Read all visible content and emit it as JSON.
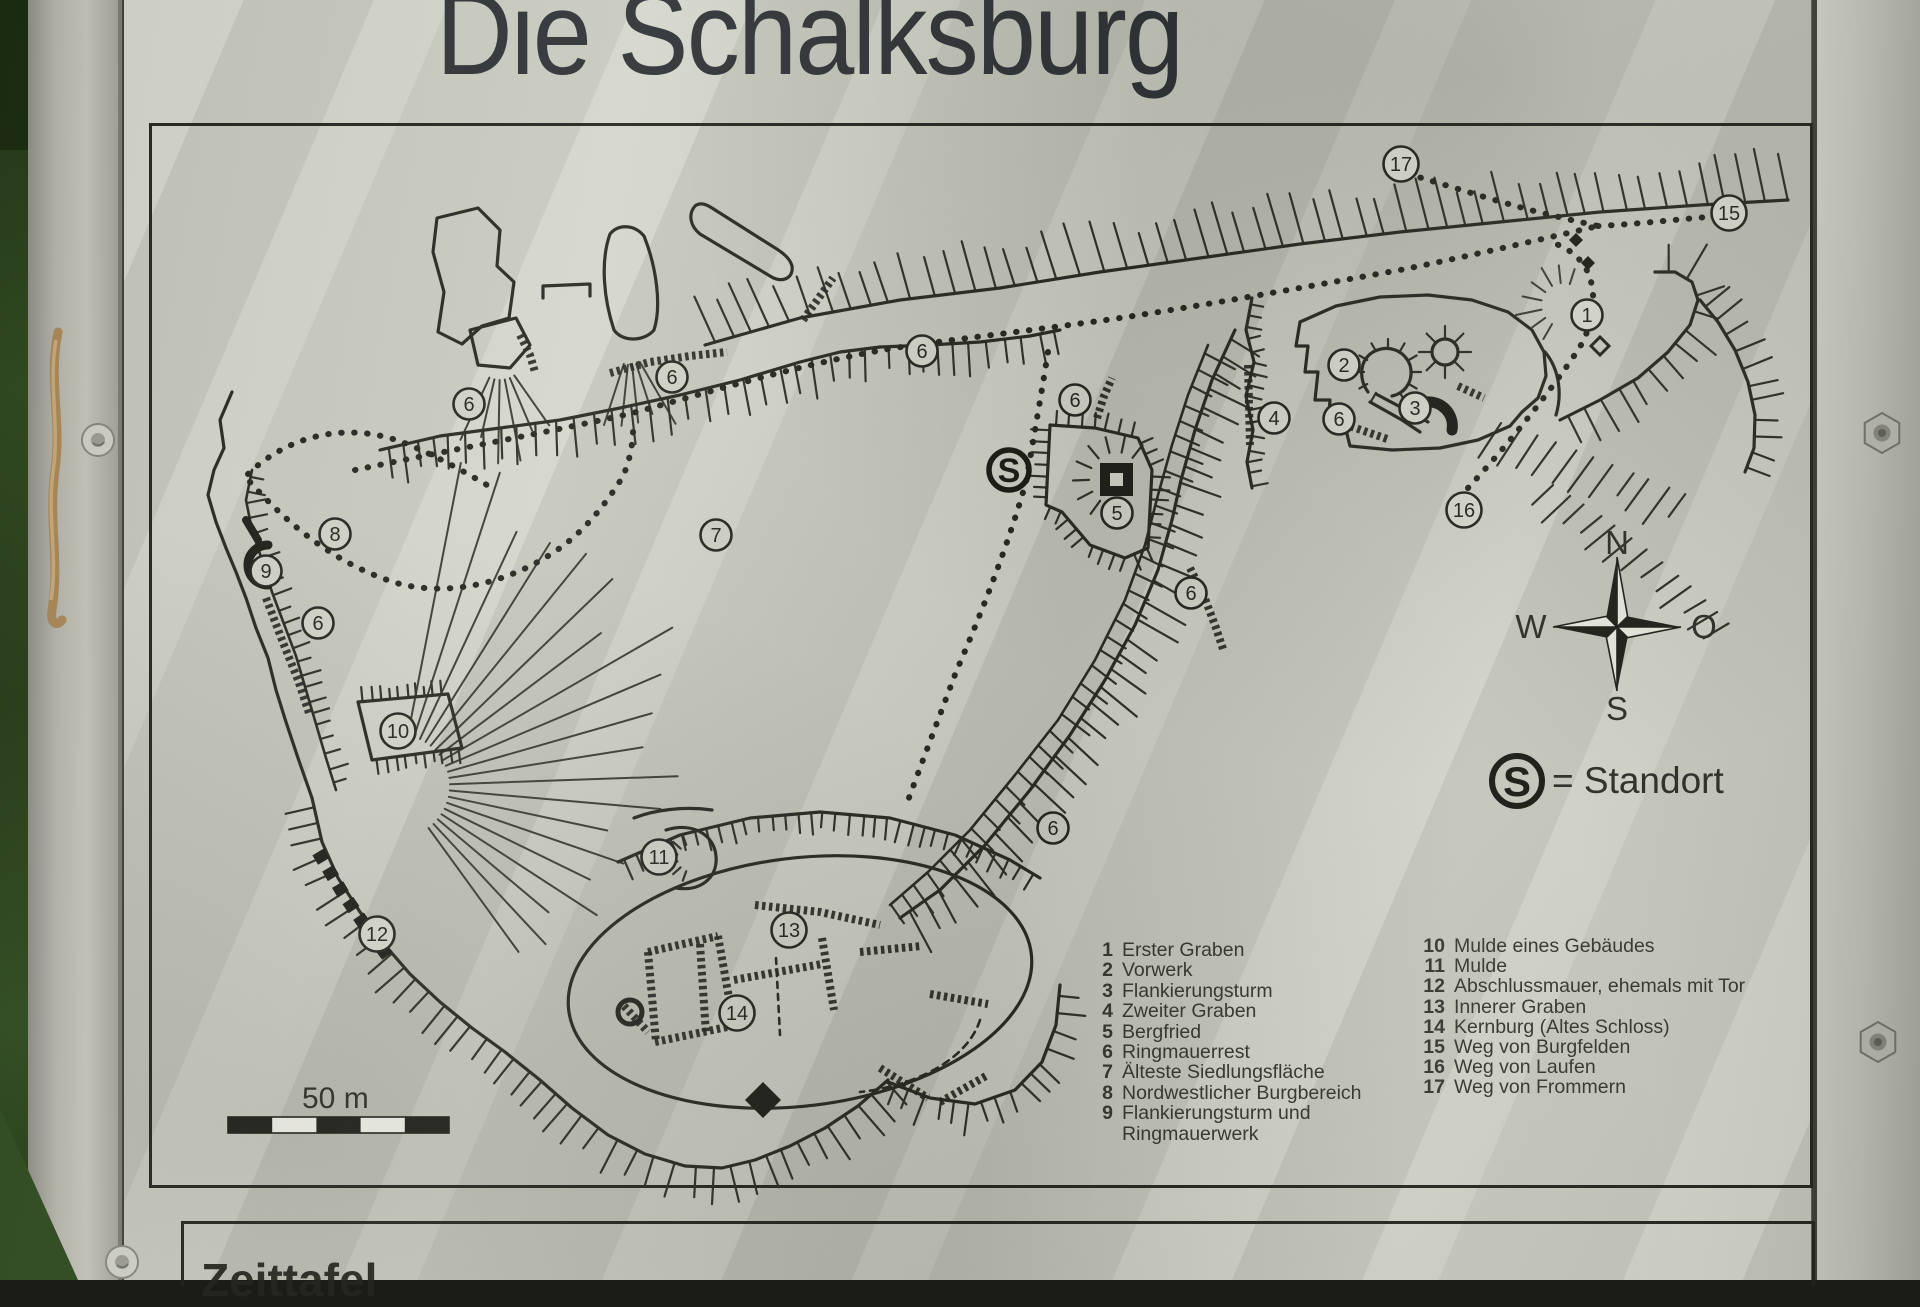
{
  "sign": {
    "title": "Die Schalksburg",
    "bottom_panel_title": "Zeittafel",
    "scale_label": "50 m",
    "standort_legend": {
      "symbol": "S",
      "text": "= Standort"
    },
    "compass": {
      "north": "N",
      "west": "W",
      "east": "O",
      "south": "S"
    },
    "colors": {
      "ink": "#26261f",
      "panel": "#cfd1c6"
    }
  },
  "map": {
    "standort_marker": {
      "symbol": "S",
      "x": 1009,
      "y": 470
    },
    "markers": [
      {
        "n": "17",
        "x": 1401,
        "y": 164
      },
      {
        "n": "15",
        "x": 1729,
        "y": 213
      },
      {
        "n": "1",
        "x": 1587,
        "y": 315
      },
      {
        "n": "2",
        "x": 1344,
        "y": 365
      },
      {
        "n": "6",
        "x": 1339,
        "y": 419
      },
      {
        "n": "3",
        "x": 1415,
        "y": 408
      },
      {
        "n": "4",
        "x": 1274,
        "y": 418
      },
      {
        "n": "6",
        "x": 1075,
        "y": 400
      },
      {
        "n": "5",
        "x": 1117,
        "y": 513
      },
      {
        "n": "6",
        "x": 922,
        "y": 351
      },
      {
        "n": "6",
        "x": 672,
        "y": 377
      },
      {
        "n": "6",
        "x": 469,
        "y": 404
      },
      {
        "n": "7",
        "x": 716,
        "y": 535
      },
      {
        "n": "8",
        "x": 335,
        "y": 534
      },
      {
        "n": "9",
        "x": 266,
        "y": 571
      },
      {
        "n": "6",
        "x": 318,
        "y": 623
      },
      {
        "n": "10",
        "x": 398,
        "y": 731
      },
      {
        "n": "11",
        "x": 659,
        "y": 857
      },
      {
        "n": "12",
        "x": 377,
        "y": 934
      },
      {
        "n": "13",
        "x": 789,
        "y": 930
      },
      {
        "n": "14",
        "x": 737,
        "y": 1013
      },
      {
        "n": "6",
        "x": 1053,
        "y": 828
      },
      {
        "n": "6",
        "x": 1191,
        "y": 593
      },
      {
        "n": "16",
        "x": 1464,
        "y": 510
      }
    ],
    "legend_left": [
      {
        "num": "1",
        "text": "Erster Graben"
      },
      {
        "num": "2",
        "text": "Vorwerk"
      },
      {
        "num": "3",
        "text": "Flankierungsturm"
      },
      {
        "num": "4",
        "text": "Zweiter Graben"
      },
      {
        "num": "5",
        "text": "Bergfried"
      },
      {
        "num": "6",
        "text": "Ringmauerrest"
      },
      {
        "num": "7",
        "text": "Älteste Siedlungsfläche"
      },
      {
        "num": "8",
        "text": "Nordwestlicher Burgbereich"
      },
      {
        "num": "9",
        "text": "Flankierungsturm und"
      },
      {
        "num": "",
        "text": "Ringmauerwerk"
      }
    ],
    "legend_right": [
      {
        "num": "10",
        "text": "Mulde eines Gebäudes"
      },
      {
        "num": "11",
        "text": "Mulde"
      },
      {
        "num": "12",
        "text": "Abschlussmauer, ehemals mit Tor"
      },
      {
        "num": "13",
        "text": "Innerer Graben"
      },
      {
        "num": "14",
        "text": "Kernburg (Altes Schloss)"
      },
      {
        "num": "15",
        "text": "Weg von Burgfelden"
      },
      {
        "num": "16",
        "text": "Weg von Laufen"
      },
      {
        "num": "17",
        "text": "Weg von Frommern"
      }
    ]
  }
}
